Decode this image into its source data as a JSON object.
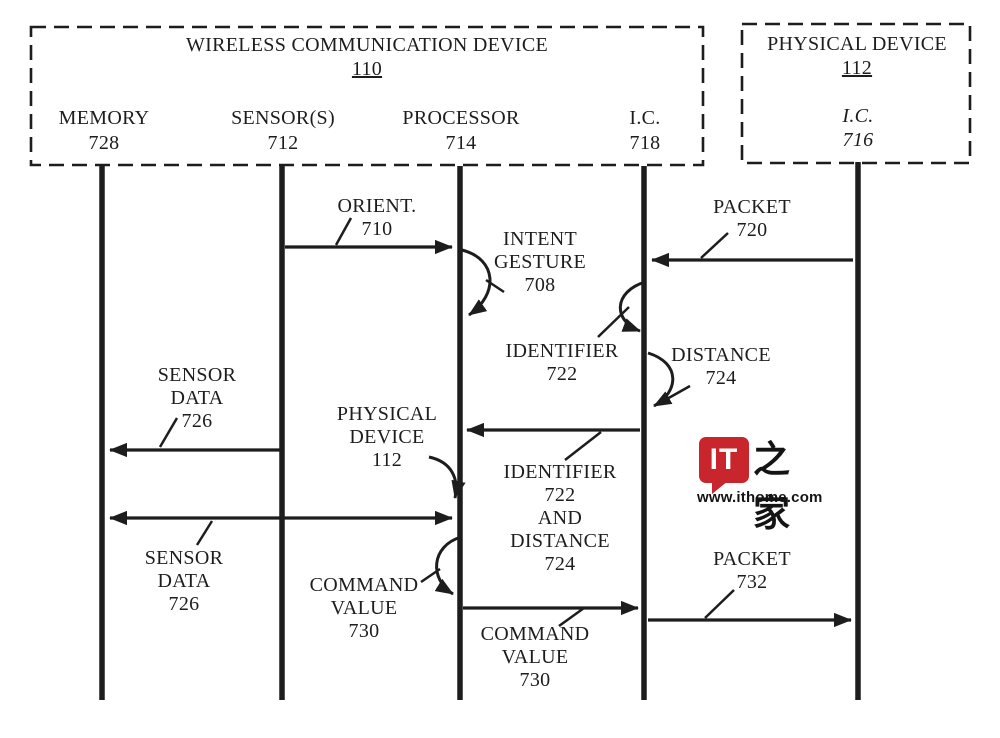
{
  "colors": {
    "ink": "#1d1d1d",
    "background": "#ffffff",
    "watermark_red": "#c9252c"
  },
  "devices": {
    "wireless": {
      "title": "WIRELESS COMMUNICATION DEVICE",
      "ref": "110"
    },
    "physical": {
      "title": "PHYSICAL DEVICE",
      "ref": "112",
      "inner_component": "I.C.",
      "inner_component_ref": "716"
    }
  },
  "lifelines": [
    {
      "name": "MEMORY",
      "ref": "728"
    },
    {
      "name": "SENSOR(S)",
      "ref": "712"
    },
    {
      "name": "PROCESSOR",
      "ref": "714"
    },
    {
      "name": "I.C.",
      "ref": "718"
    },
    {
      "name": "I.C.",
      "ref": "716"
    }
  ],
  "messages": {
    "orient": {
      "lines": [
        "ORIENT.",
        "710"
      ]
    },
    "intent_gesture": {
      "lines": [
        "INTENT",
        "GESTURE",
        "708"
      ]
    },
    "packet_720": {
      "lines": [
        "PACKET",
        "720"
      ]
    },
    "identifier_722": {
      "lines": [
        "IDENTIFIER",
        "722"
      ]
    },
    "distance_724": {
      "lines": [
        "DISTANCE",
        "724"
      ]
    },
    "sensor_data_top": {
      "lines": [
        "SENSOR",
        "DATA",
        "726"
      ]
    },
    "physical_device": {
      "lines": [
        "PHYSICAL",
        "DEVICE",
        "112"
      ]
    },
    "identifier_and_distance": {
      "lines": [
        "IDENTIFIER",
        "722",
        "AND",
        "DISTANCE",
        "724"
      ]
    },
    "sensor_data_bottom": {
      "lines": [
        "SENSOR",
        "DATA",
        "726"
      ]
    },
    "command_value_left": {
      "lines": [
        "COMMAND",
        "VALUE",
        "730"
      ]
    },
    "packet_732": {
      "lines": [
        "PACKET",
        "732"
      ]
    },
    "command_value_bottom": {
      "lines": [
        "COMMAND",
        "VALUE",
        "730"
      ]
    }
  },
  "flows": [
    {
      "label": "ORIENT. 710",
      "from": "SENSOR(S) 712",
      "to": "PROCESSOR 714",
      "direction": "right"
    },
    {
      "label": "INTENT GESTURE 708",
      "from": "PROCESSOR 714",
      "to": "PROCESSOR 714",
      "direction": "self"
    },
    {
      "label": "PACKET 720",
      "from": "I.C. 716",
      "to": "I.C. 718",
      "direction": "left"
    },
    {
      "label": "IDENTIFIER 722",
      "from": "I.C. 718",
      "to": "I.C. 718",
      "direction": "self"
    },
    {
      "label": "DISTANCE 724",
      "from": "I.C. 718",
      "to": "I.C. 718",
      "direction": "self"
    },
    {
      "label": "SENSOR DATA 726",
      "from": "SENSOR(S) 712",
      "to": "MEMORY 728",
      "direction": "left"
    },
    {
      "label": "IDENTIFIER 722 AND DISTANCE 724",
      "from": "I.C. 718",
      "to": "PROCESSOR 714",
      "direction": "left"
    },
    {
      "label": "PHYSICAL DEVICE 112",
      "from": "annotation",
      "to": "PROCESSOR 714",
      "direction": "pointer"
    },
    {
      "label": "SENSOR DATA 726",
      "from": "MEMORY 728",
      "to": "PROCESSOR 714",
      "direction": "both"
    },
    {
      "label": "COMMAND VALUE 730",
      "from": "PROCESSOR 714",
      "to": "PROCESSOR 714",
      "direction": "self"
    },
    {
      "label": "COMMAND VALUE 730",
      "from": "PROCESSOR 714",
      "to": "I.C. 718",
      "direction": "right"
    },
    {
      "label": "PACKET 732",
      "from": "I.C. 718",
      "to": "I.C. 716",
      "direction": "right"
    }
  ],
  "watermark": {
    "logo": "IT",
    "cjk": "之家",
    "url": "www.ithome.com"
  }
}
